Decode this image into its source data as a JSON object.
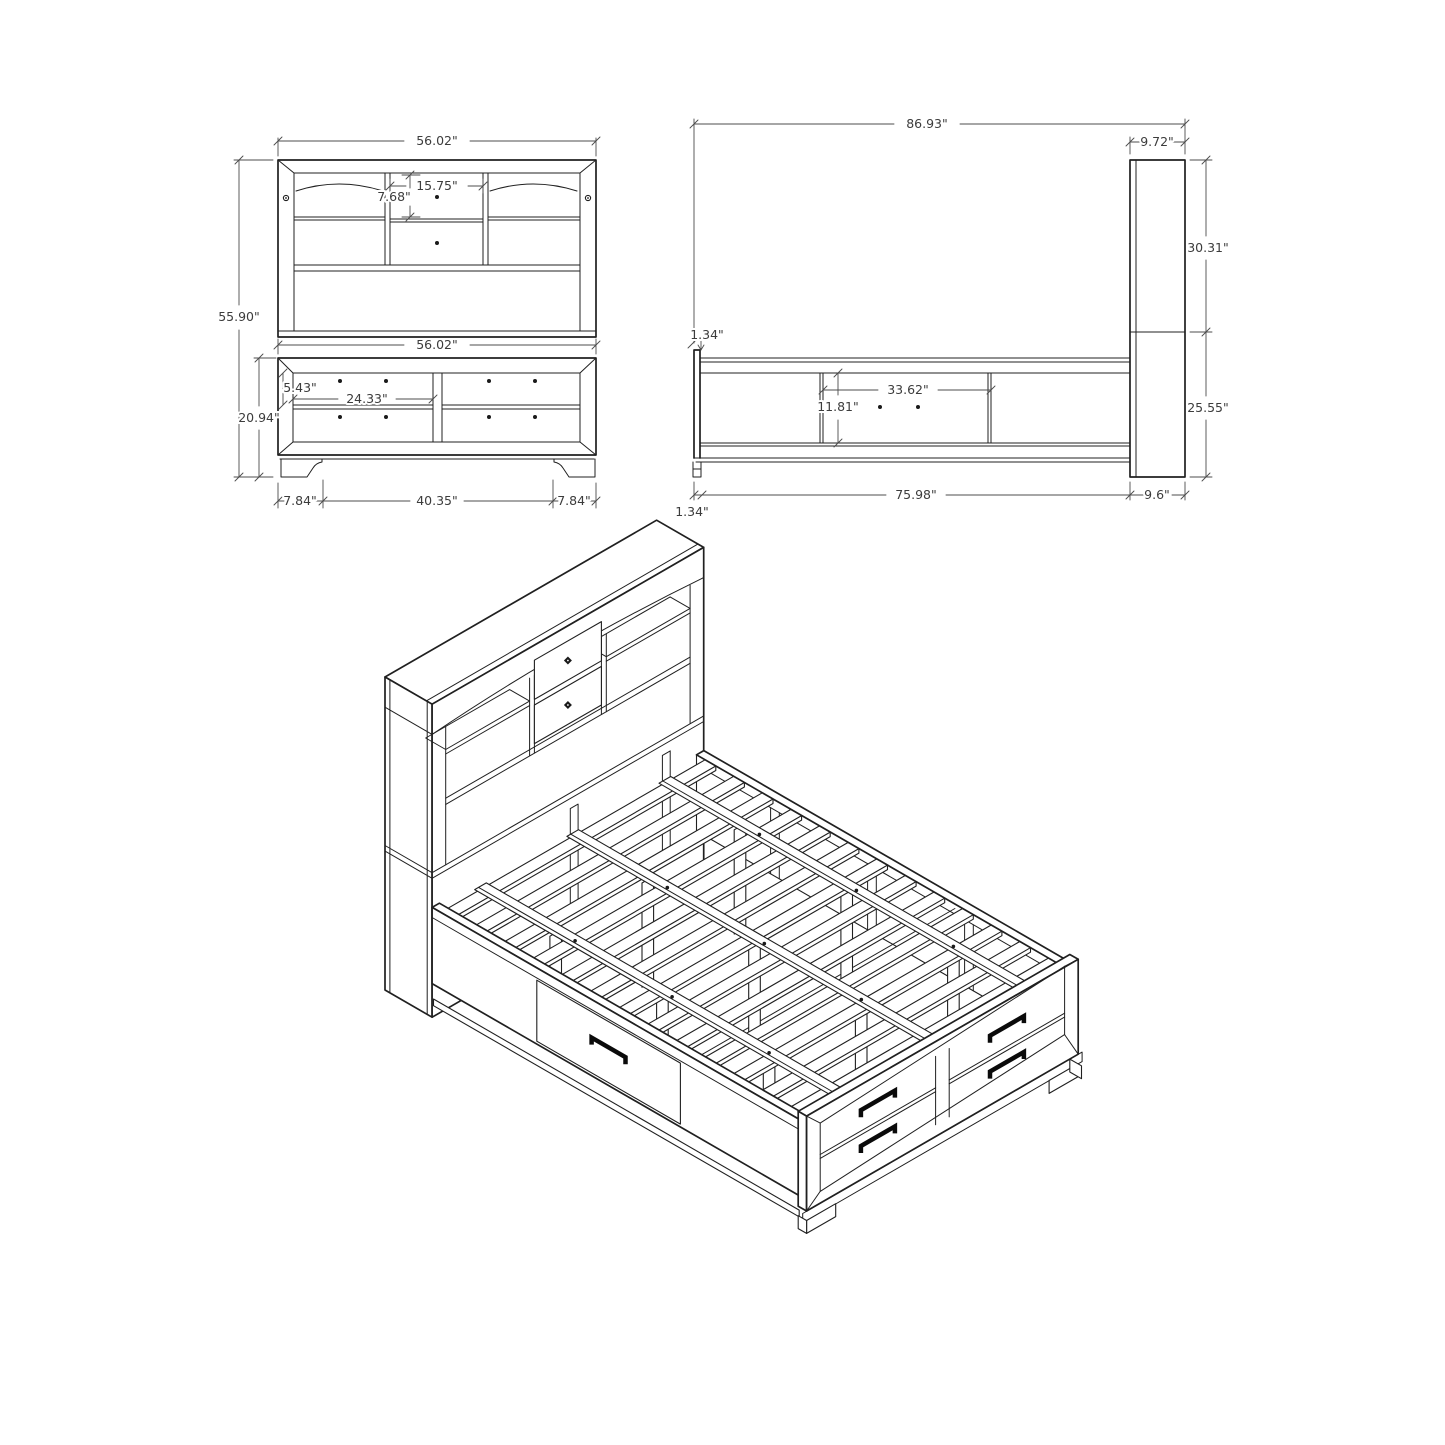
{
  "drawing": {
    "kind": "furniture dimension drawing",
    "subject": "storage bed with bookcase headboard",
    "line_color": "#202020",
    "dim_color": "#4c4c4c",
    "background": "#ffffff"
  },
  "dims": {
    "front": {
      "overall_width": "56.02\"",
      "overall_height": "55.90\"",
      "center_opening_width": "15.75\"",
      "center_opening_height": "7.68\"",
      "footboard_width": "56.02\"",
      "drawer_height": "5.43\"",
      "drawer_width": "24.33\"",
      "footboard_height": "20.94\"",
      "foot_inset_left": "7.84\"",
      "feet_span": "40.35\"",
      "foot_inset_right": "7.84\""
    },
    "side": {
      "overall_length": "86.93\"",
      "headboard_depth": "9.72\"",
      "headboard_upper_height": "30.31\"",
      "footboard_lip": "1.34\"",
      "side_opening_width": "33.62\"",
      "side_opening_height": "11.81\"",
      "rail_length": "75.98\"",
      "headboard_lower_height": "25.55\"",
      "base_depth": "9.6\"",
      "footboard_thickness": "1.34\""
    }
  }
}
